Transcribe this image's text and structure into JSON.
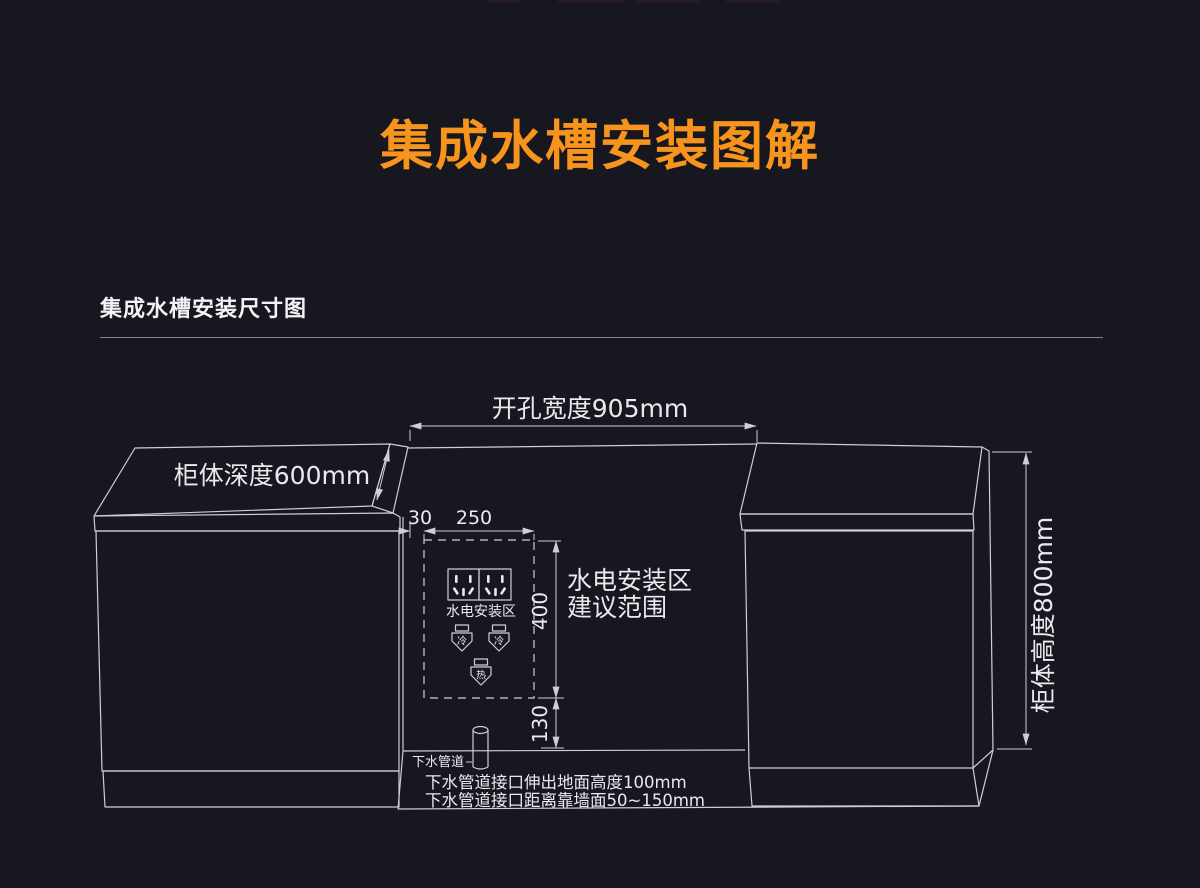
{
  "colors": {
    "background": "#17171F",
    "title_accent": "#F7941D",
    "line": "#CDCED6",
    "text": "#E9EAEE",
    "divider": "#83838D"
  },
  "title": "集成水槽安装图解",
  "section_heading": "集成水槽安装尺寸图",
  "dimensions": {
    "opening_width": "开孔宽度905mm",
    "cabinet_depth": "柜体深度600mm",
    "cabinet_height": "柜体高度800mm",
    "zone_offset": "30",
    "zone_width": "250",
    "zone_height": "400",
    "zone_bottom_gap": "130"
  },
  "zone": {
    "socket_area_label": "水电安装区",
    "range_note_line1": "水电安装区",
    "range_note_line2": "建议范围",
    "cold_valve": "冷",
    "hot_valve": "热"
  },
  "drain": {
    "pipe_label": "下水管道",
    "note_height": "下水管道接口伸出地面高度100mm",
    "note_distance": "下水管道接口距离靠墙面50~150mm"
  }
}
